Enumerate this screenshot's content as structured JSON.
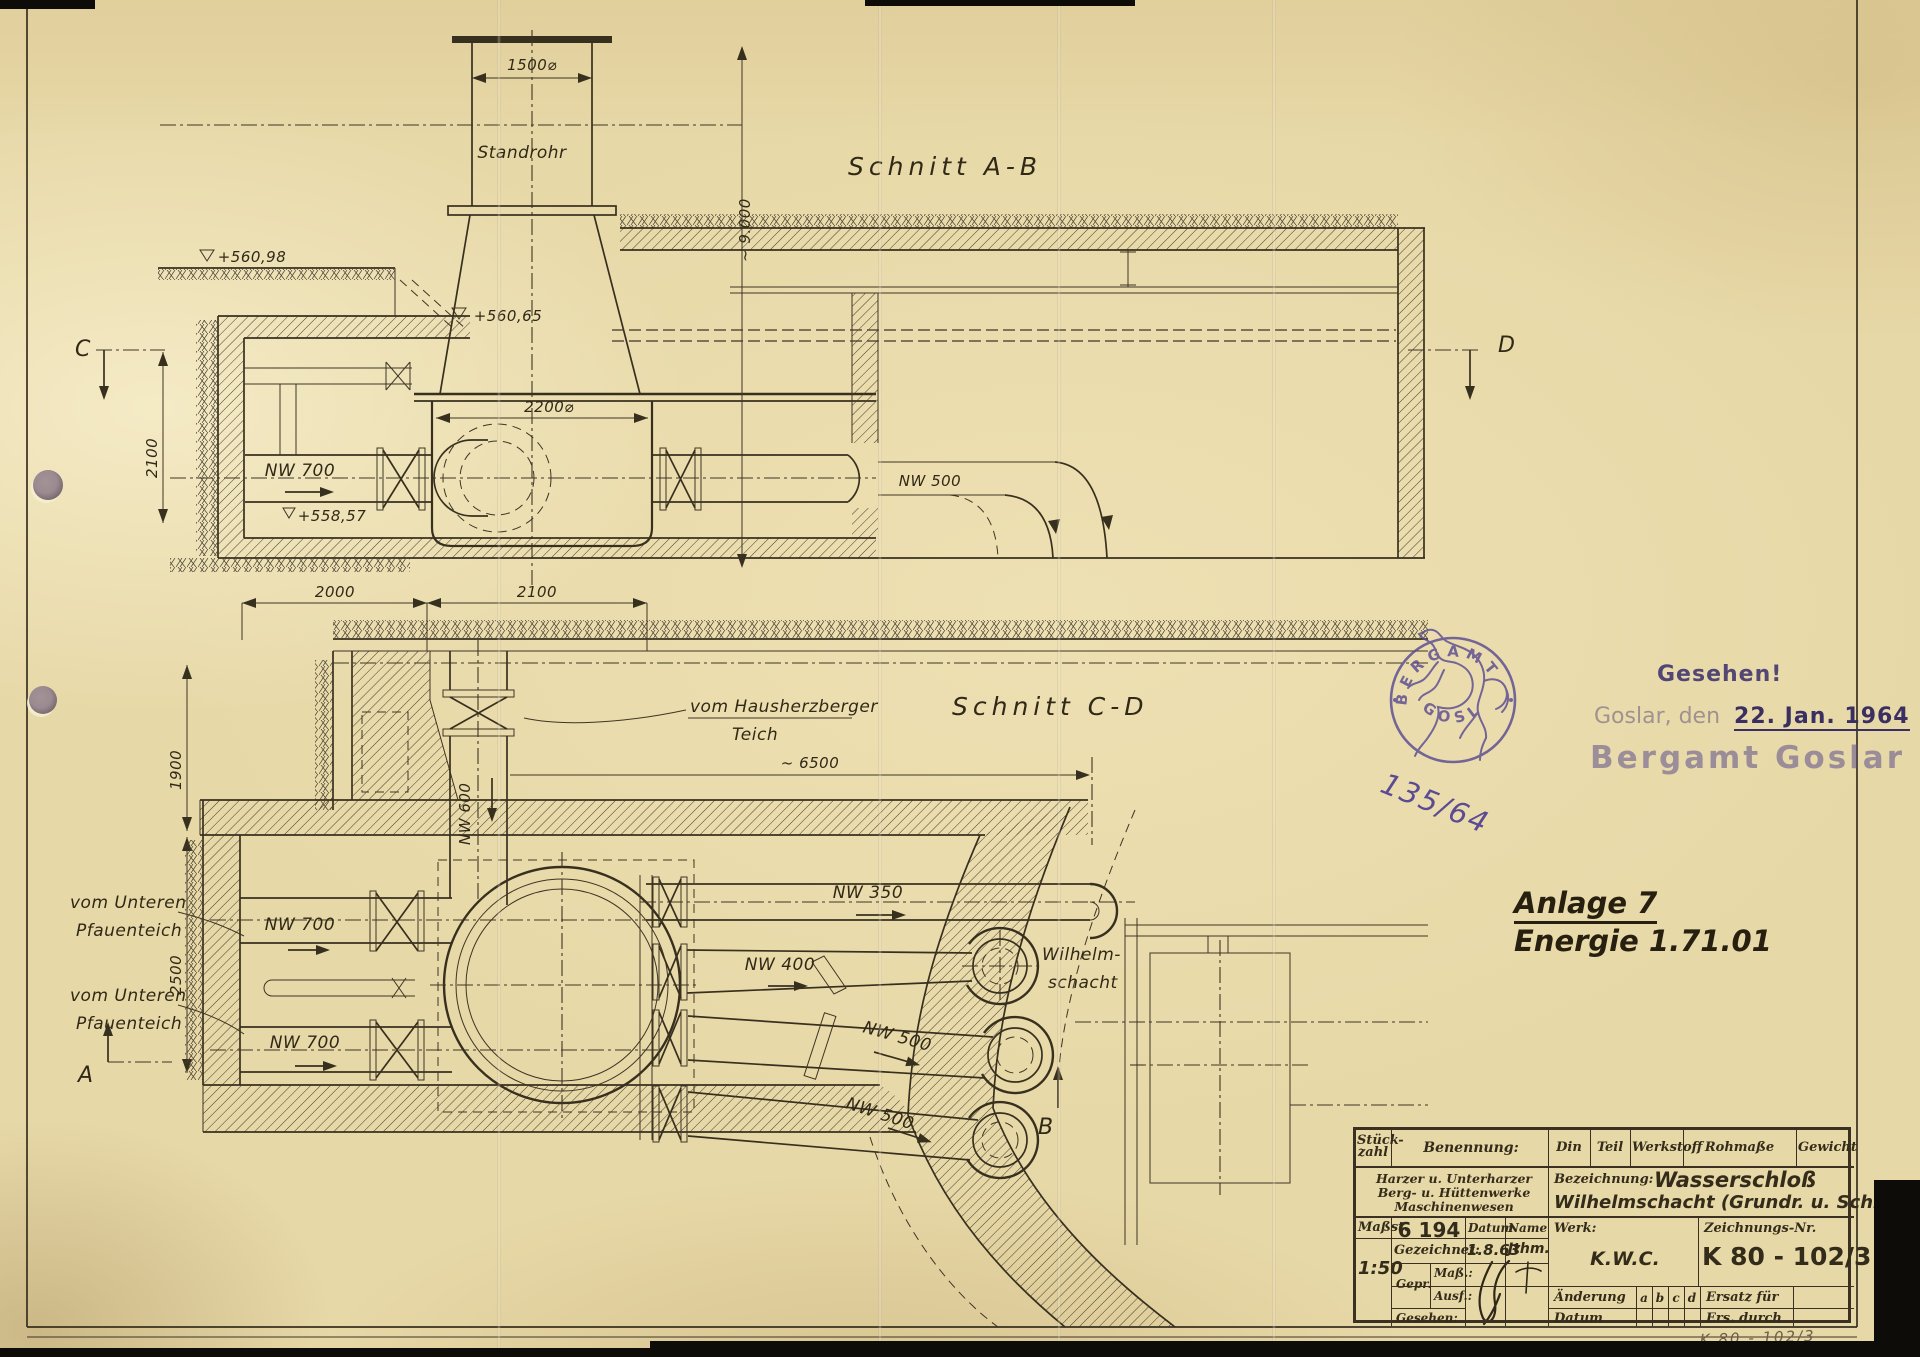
{
  "sections": {
    "ab": {
      "title": "Schnitt A-B",
      "labels": {
        "standrohr": "Standrohr",
        "nw700": "NW 700",
        "nw500": "NW 500"
      },
      "levels": {
        "ground": "+560,98",
        "mid": "+560,65",
        "low": "+558,57"
      },
      "dims": {
        "top_width": "1500⌀",
        "height": "~ 9.000",
        "tank": "2200⌀",
        "left": "2100"
      },
      "markers": {
        "c": "C",
        "d": "D"
      }
    },
    "cd": {
      "title": "Schnitt C-D",
      "labels": {
        "feed_top1": "vom Hausherzberger",
        "feed_top2": "Teich",
        "feed1a": "vom Unteren",
        "feed1b": "Pfauenteich",
        "feed2a": "vom Unteren",
        "feed2b": "Pfauenteich",
        "nw600": "NW 600",
        "nw700_1": "NW 700",
        "nw700_2": "NW 700",
        "nw350": "NW 350",
        "nw400": "NW 400",
        "nw500_1": "NW 500",
        "nw500_2": "NW 500",
        "shaft1": "Wilhelm-",
        "shaft2": "schacht"
      },
      "dims": {
        "w1": "2000",
        "w2": "2100",
        "h1": "1900",
        "h2": "2500",
        "span": "~ 6500"
      },
      "markers": {
        "a": "A",
        "b": "B"
      }
    }
  },
  "annotations": {
    "anlage_1": "Anlage 7",
    "anlage_2": "Energie 1.71.01",
    "pencil_no": "K 80 - 102/3"
  },
  "stamps": {
    "round": {
      "top": "BERGAMT",
      "bottom": "GOSLAR",
      "number": "135/64"
    },
    "seen": {
      "line1": "Gesehen!",
      "line2_pre": "Goslar, den",
      "line2_date": "22. Jan. 1964",
      "line3": "Bergamt Goslar"
    }
  },
  "title_block": {
    "stueck_1": "Stück-",
    "stueck_2": "zahl",
    "benennung": "Benennung:",
    "din": "Din",
    "teil": "Teil",
    "werkstoff": "Werkstoff",
    "rohmasse": "Rohmaße",
    "gewicht": "Gewicht",
    "company_1": "Harzer u. Unterharzer",
    "company_2": "Berg- u. Hüttenwerke",
    "company_3": "Maschinenwesen",
    "bezeichnung_label": "Bezeichnung:",
    "bezeichnung_1": "Wasserschloß",
    "bezeichnung_2": "Wilhelmschacht (Grundr. u. Schnitt)",
    "massstab_label": "Maßst.",
    "massstab_value": "1:50",
    "order_no": "6 194",
    "datum_label": "Datum",
    "name_label": "Name",
    "gezeichnet_label": "Gezeichnet:",
    "gezeichnet_datum": "1.8.63",
    "gezeichnet_name": "Jthm.",
    "gepr_label": "Gepr.",
    "mass_label": "Maß.:",
    "ausf_label": "Ausf.:",
    "gesehen_label": "Gesehen:",
    "werk_label": "Werk:",
    "werk_value": "K.W.C.",
    "znr_label": "Zeichnungs-Nr.",
    "znr_value": "K 80 - 102/3",
    "aenderung_label": "Änderung",
    "rev_a": "a",
    "rev_b": "b",
    "rev_c": "c",
    "rev_d": "d",
    "ersatz_label": "Ersatz für",
    "datum2_label": "Datum",
    "ers_durch_label": "Ers. durch"
  },
  "colors": {
    "paper": "#e7d8a7",
    "ink": "#38301f",
    "stamp_purple": "#5a4b92",
    "pencil": "#6e6049"
  }
}
